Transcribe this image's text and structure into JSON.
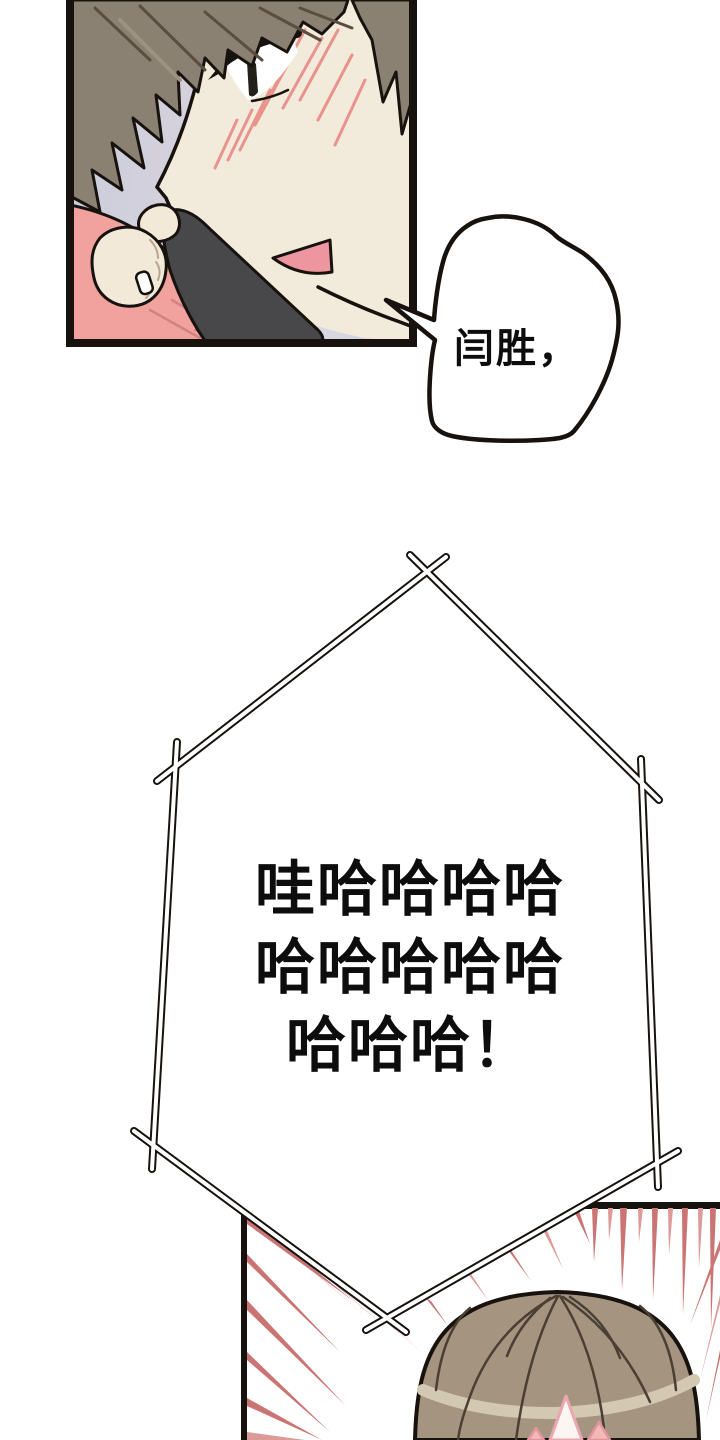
{
  "speech": {
    "phone_bubble": {
      "text": "闫胜，"
    },
    "laugh_burst": {
      "lines": [
        "哇哈哈哈哈",
        "哈哈哈哈哈",
        "哈哈哈！"
      ]
    }
  },
  "colors": {
    "paper": "#ffffff",
    "ink": "#17120e",
    "textInk": "#0d0d0d",
    "bgBlue": "#c7cdda",
    "bgLav1": "#d8d2dd",
    "bgLav2": "#e6dbe2",
    "bgBlue2": "#cfd4e1",
    "face": "#f2ebdb",
    "hairTop": "#8b8172",
    "hairTopDark": "#5a4e40",
    "hairTopLight": "#9d927f",
    "blush": "#e9938d",
    "eyeDark": "#23201b",
    "mouth": "#ee96a0",
    "phone": "#48484a",
    "arm": "#f1a29e",
    "armLine": "#d2837f",
    "fist": "#f2e9d8",
    "knuckle": "#b9a58f",
    "speed": "#ca7473",
    "speedLight": "#dc9b99",
    "hairB": "#a49480",
    "hairBHl": "#d3c8b2",
    "hairBLine": "#4a3f32",
    "spikeFill": "#fdf5f2",
    "spikeStroke": "#eba7b0",
    "spike2": "#f3b9b4",
    "spike2Stroke": "#e295a0"
  }
}
